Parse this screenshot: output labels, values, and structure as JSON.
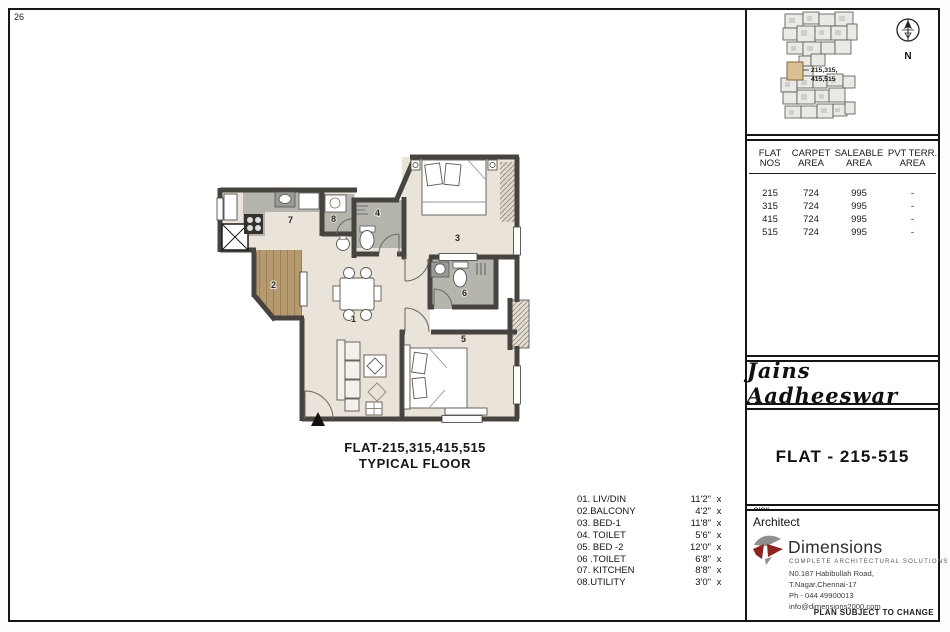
{
  "page": {
    "sheet_number": "26",
    "footer_note": "PLAN SUBJECT TO CHANGE"
  },
  "plan": {
    "caption_line1": "FLAT-215,315,415,515",
    "caption_line2": "TYPICAL FLOOR",
    "room_numbers": [
      "1",
      "2",
      "3",
      "4",
      "5",
      "6",
      "7",
      "8"
    ]
  },
  "legend": {
    "dim_sep": "x",
    "items": [
      {
        "label": "01. LIV/DIN",
        "w": "11'2\"",
        "h": "19'8\""
      },
      {
        "label": "02.BALCONY",
        "w": "4'2\"",
        "h": "8'0\""
      },
      {
        "label": "03. BED-1",
        "w": "11'8\"",
        "h": "12'0\""
      },
      {
        "label": "04. TOILET",
        "w": "5'6\"",
        "h": "6'2\""
      },
      {
        "label": "05. BED -2",
        "w": "12'0\"",
        "h": "12'8\""
      },
      {
        "label": "06 .TOILET",
        "w": "6'8\"",
        "h": "5'8\""
      },
      {
        "label": "07. KITCHEN",
        "w": "8'8\"",
        "h": "7'6\""
      },
      {
        "label": "08.UTILITY",
        "w": "3'0\"",
        "h": "5'0\""
      }
    ]
  },
  "keyplan": {
    "unit_label_line1": "215,315,",
    "unit_label_line2": "415,515",
    "north_label": "N"
  },
  "area_table": {
    "headers": [
      "FLAT\nNOS",
      "CARPET\nAREA",
      "SALEABLE\nAREA",
      "PVT TERR.\nAREA"
    ],
    "rows": [
      [
        "215",
        "724",
        "995",
        "-"
      ],
      [
        "315",
        "724",
        "995",
        "-"
      ],
      [
        "415",
        "724",
        "995",
        "-"
      ],
      [
        "515",
        "724",
        "995",
        "-"
      ]
    ]
  },
  "project": {
    "name": "Jains Aadheeswar",
    "flat_title": "FLAT - 215-515"
  },
  "architect": {
    "label": "Architect",
    "brand": "Dimensions",
    "tagline": "COMPLETE ARCHITECTURAL SOLUTIONS",
    "address1": "N0.187 Habibullah  Road,",
    "address2": "T.Nagar,Chennai-17",
    "phone": "Ph - 044 49900013",
    "email": "info@dimensions2000.com"
  },
  "colors": {
    "wall": "#47443f",
    "floor": "#e9e3d9",
    "tile": "#b5b5ae",
    "wood": "#b49a6e",
    "logo_red": "#8e2420",
    "keyplan_highlight": "#d8bf95"
  }
}
